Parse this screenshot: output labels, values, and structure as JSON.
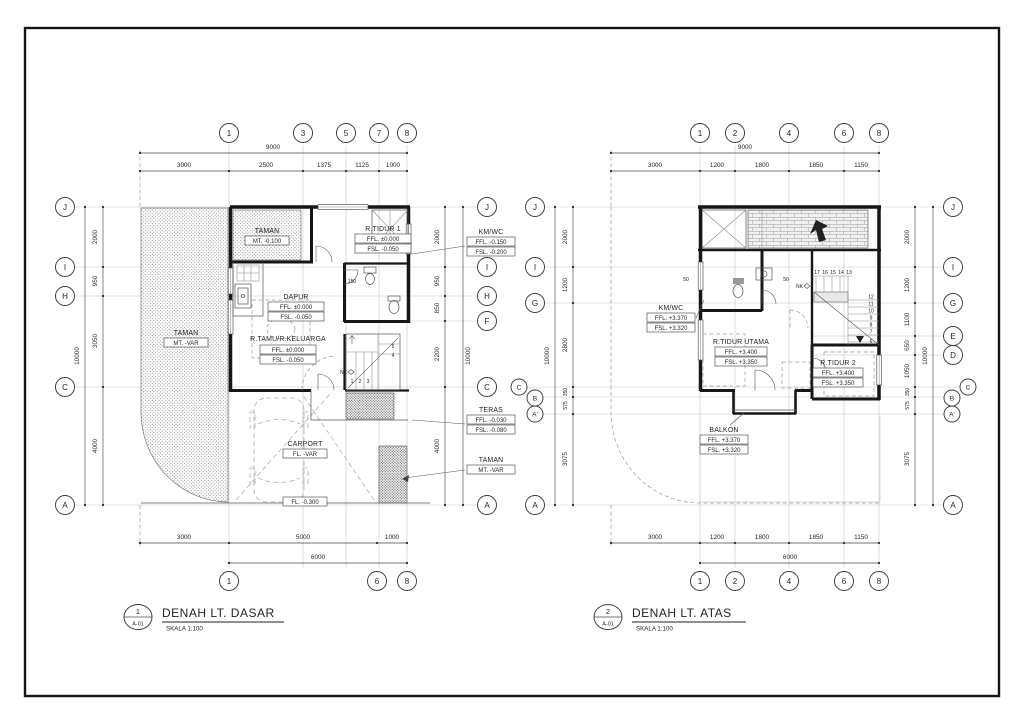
{
  "left_plan": {
    "title": {
      "num": "1",
      "sheet": "A-01",
      "name": "DENAH LT. DASAR",
      "scale": "SKALA 1:100"
    },
    "top": {
      "overall": "9000",
      "segs": [
        "3000",
        "2500",
        "1375",
        "1125",
        "1000"
      ],
      "bubbles": [
        "1",
        "3",
        "5",
        "7",
        "8"
      ]
    },
    "bottom": {
      "overall": "6000",
      "segs": [
        "3000",
        "5000",
        "1000"
      ],
      "bubbles": [
        "1",
        "6",
        "8"
      ]
    },
    "west": {
      "overall": "10000",
      "segs": [
        "2000",
        "950",
        "3050",
        "4000"
      ],
      "bubbles": [
        "J",
        "I",
        "H",
        "C",
        "A"
      ]
    },
    "east": {
      "overall": "10000",
      "segs": [
        "2000",
        "950",
        "850",
        "2200",
        "4000"
      ],
      "bubbles": [
        "J",
        "I",
        "H",
        "F",
        "C",
        "A"
      ]
    },
    "rooms": {
      "taman_top": {
        "name": "TAMAN",
        "v1": "MT. -0.100"
      },
      "rtidur1": {
        "name": "R.TIDUR 1",
        "v1": "FFL. ±0.000",
        "v2": "FSL. -0.050"
      },
      "kmwc": {
        "name": "KM/WC",
        "v1": "FFL. -0.150",
        "v2": "FSL. -0.200"
      },
      "dapur": {
        "name": "DAPUR",
        "v1": "FFL. ±0.000",
        "v2": "FSL. -0.050"
      },
      "rtamu": {
        "name": "R.TAMU/R.KELUARGA",
        "v1": "FFL. ±0.000",
        "v2": "FSL. -0.050"
      },
      "taman_left": {
        "name": "TAMAN",
        "v1": "MT. -VAR"
      },
      "carport": {
        "name": "CARPORT",
        "v1": "FL. -VAR"
      },
      "teras": {
        "name": "TERAS",
        "v1": "FFL. -0.030",
        "v2": "FSL. -0.080"
      },
      "taman_right": {
        "name": "TAMAN",
        "v1": "MT. -VAR"
      },
      "fl_low": "FL. -0.300"
    },
    "stair_nums": [
      "1",
      "2",
      "3",
      "4",
      "5"
    ],
    "nk": "NK",
    "dim150": "150"
  },
  "right_plan": {
    "title": {
      "num": "2",
      "sheet": "A-01",
      "name": "DENAH LT. ATAS",
      "scale": "SKALA 1:100"
    },
    "top": {
      "overall": "9000",
      "segs": [
        "3000",
        "1200",
        "1800",
        "1850",
        "1150"
      ],
      "bubbles": [
        "1",
        "2",
        "4",
        "6",
        "8"
      ]
    },
    "bottom": {
      "overall": "6000",
      "segs": [
        "3000",
        "1200",
        "1800",
        "1850",
        "1150"
      ],
      "bubbles": [
        "1",
        "2",
        "4",
        "6",
        "8"
      ]
    },
    "west": {
      "overall": "10000",
      "segs": [
        "2000",
        "1200",
        "2800",
        "350",
        "575",
        "3075"
      ],
      "bubbles": [
        "J",
        "I",
        "G",
        "C",
        "B",
        "A'",
        "A"
      ]
    },
    "east": {
      "overall": "10000",
      "segs": [
        "2000",
        "1200",
        "1100",
        "650",
        "1050",
        "350",
        "575",
        "3075"
      ],
      "bubbles": [
        "J",
        "I",
        "G",
        "E",
        "D",
        "C",
        "B",
        "A'",
        "A"
      ]
    },
    "rooms": {
      "kmwc": {
        "name": "KM/WC",
        "v1": "FFL. +3.370",
        "v2": "FSL. +3.320"
      },
      "utama": {
        "name": "R.TIDUR UTAMA",
        "v1": "FFL. +3.400",
        "v2": "FSL. +3.350"
      },
      "rtidur2": {
        "name": "R.TIDUR 2",
        "v1": "FFL. +3.400",
        "v2": "FSL. +3.350"
      },
      "balkon": {
        "name": "BALKON",
        "v1": "FFL. +3.370",
        "v2": "FSL. +3.320"
      }
    },
    "stairs_top": [
      "17",
      "16",
      "15",
      "14",
      "13"
    ],
    "stairs_side": [
      "12",
      "11",
      "10",
      "9",
      "8",
      "7",
      "6"
    ],
    "nk": "NK",
    "dim50": "50"
  }
}
